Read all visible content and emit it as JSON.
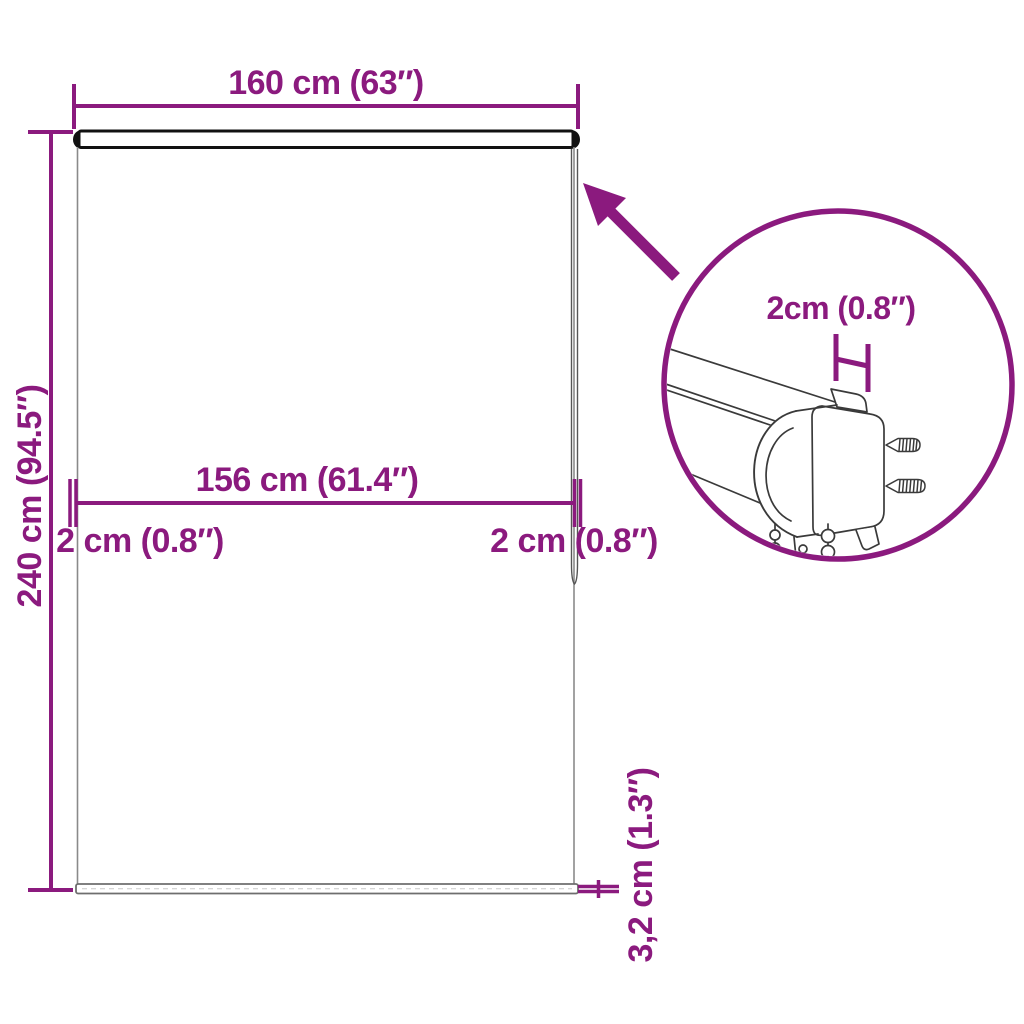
{
  "colors": {
    "accent": "#8B1A7E",
    "sketch_line": "#3a3a3a",
    "blind_outline": "#8a8a8a",
    "background": "#ffffff"
  },
  "labels": {
    "total_width": "160 cm (63″)",
    "total_height": "240 cm (94.5″)",
    "inner_width": "156 cm (61.4″)",
    "left_gap": "2 cm (0.8″)",
    "right_gap": "2 cm (0.8″)",
    "bottom_thickness": "3,2 cm (1.3″)",
    "detail_bracket_depth": "2cm (0.8″)"
  },
  "diagram": {
    "type": "product-dimension-diagram",
    "subject": "roller blind front view with zoomed detail of mounting bracket, screws and pull chain"
  }
}
